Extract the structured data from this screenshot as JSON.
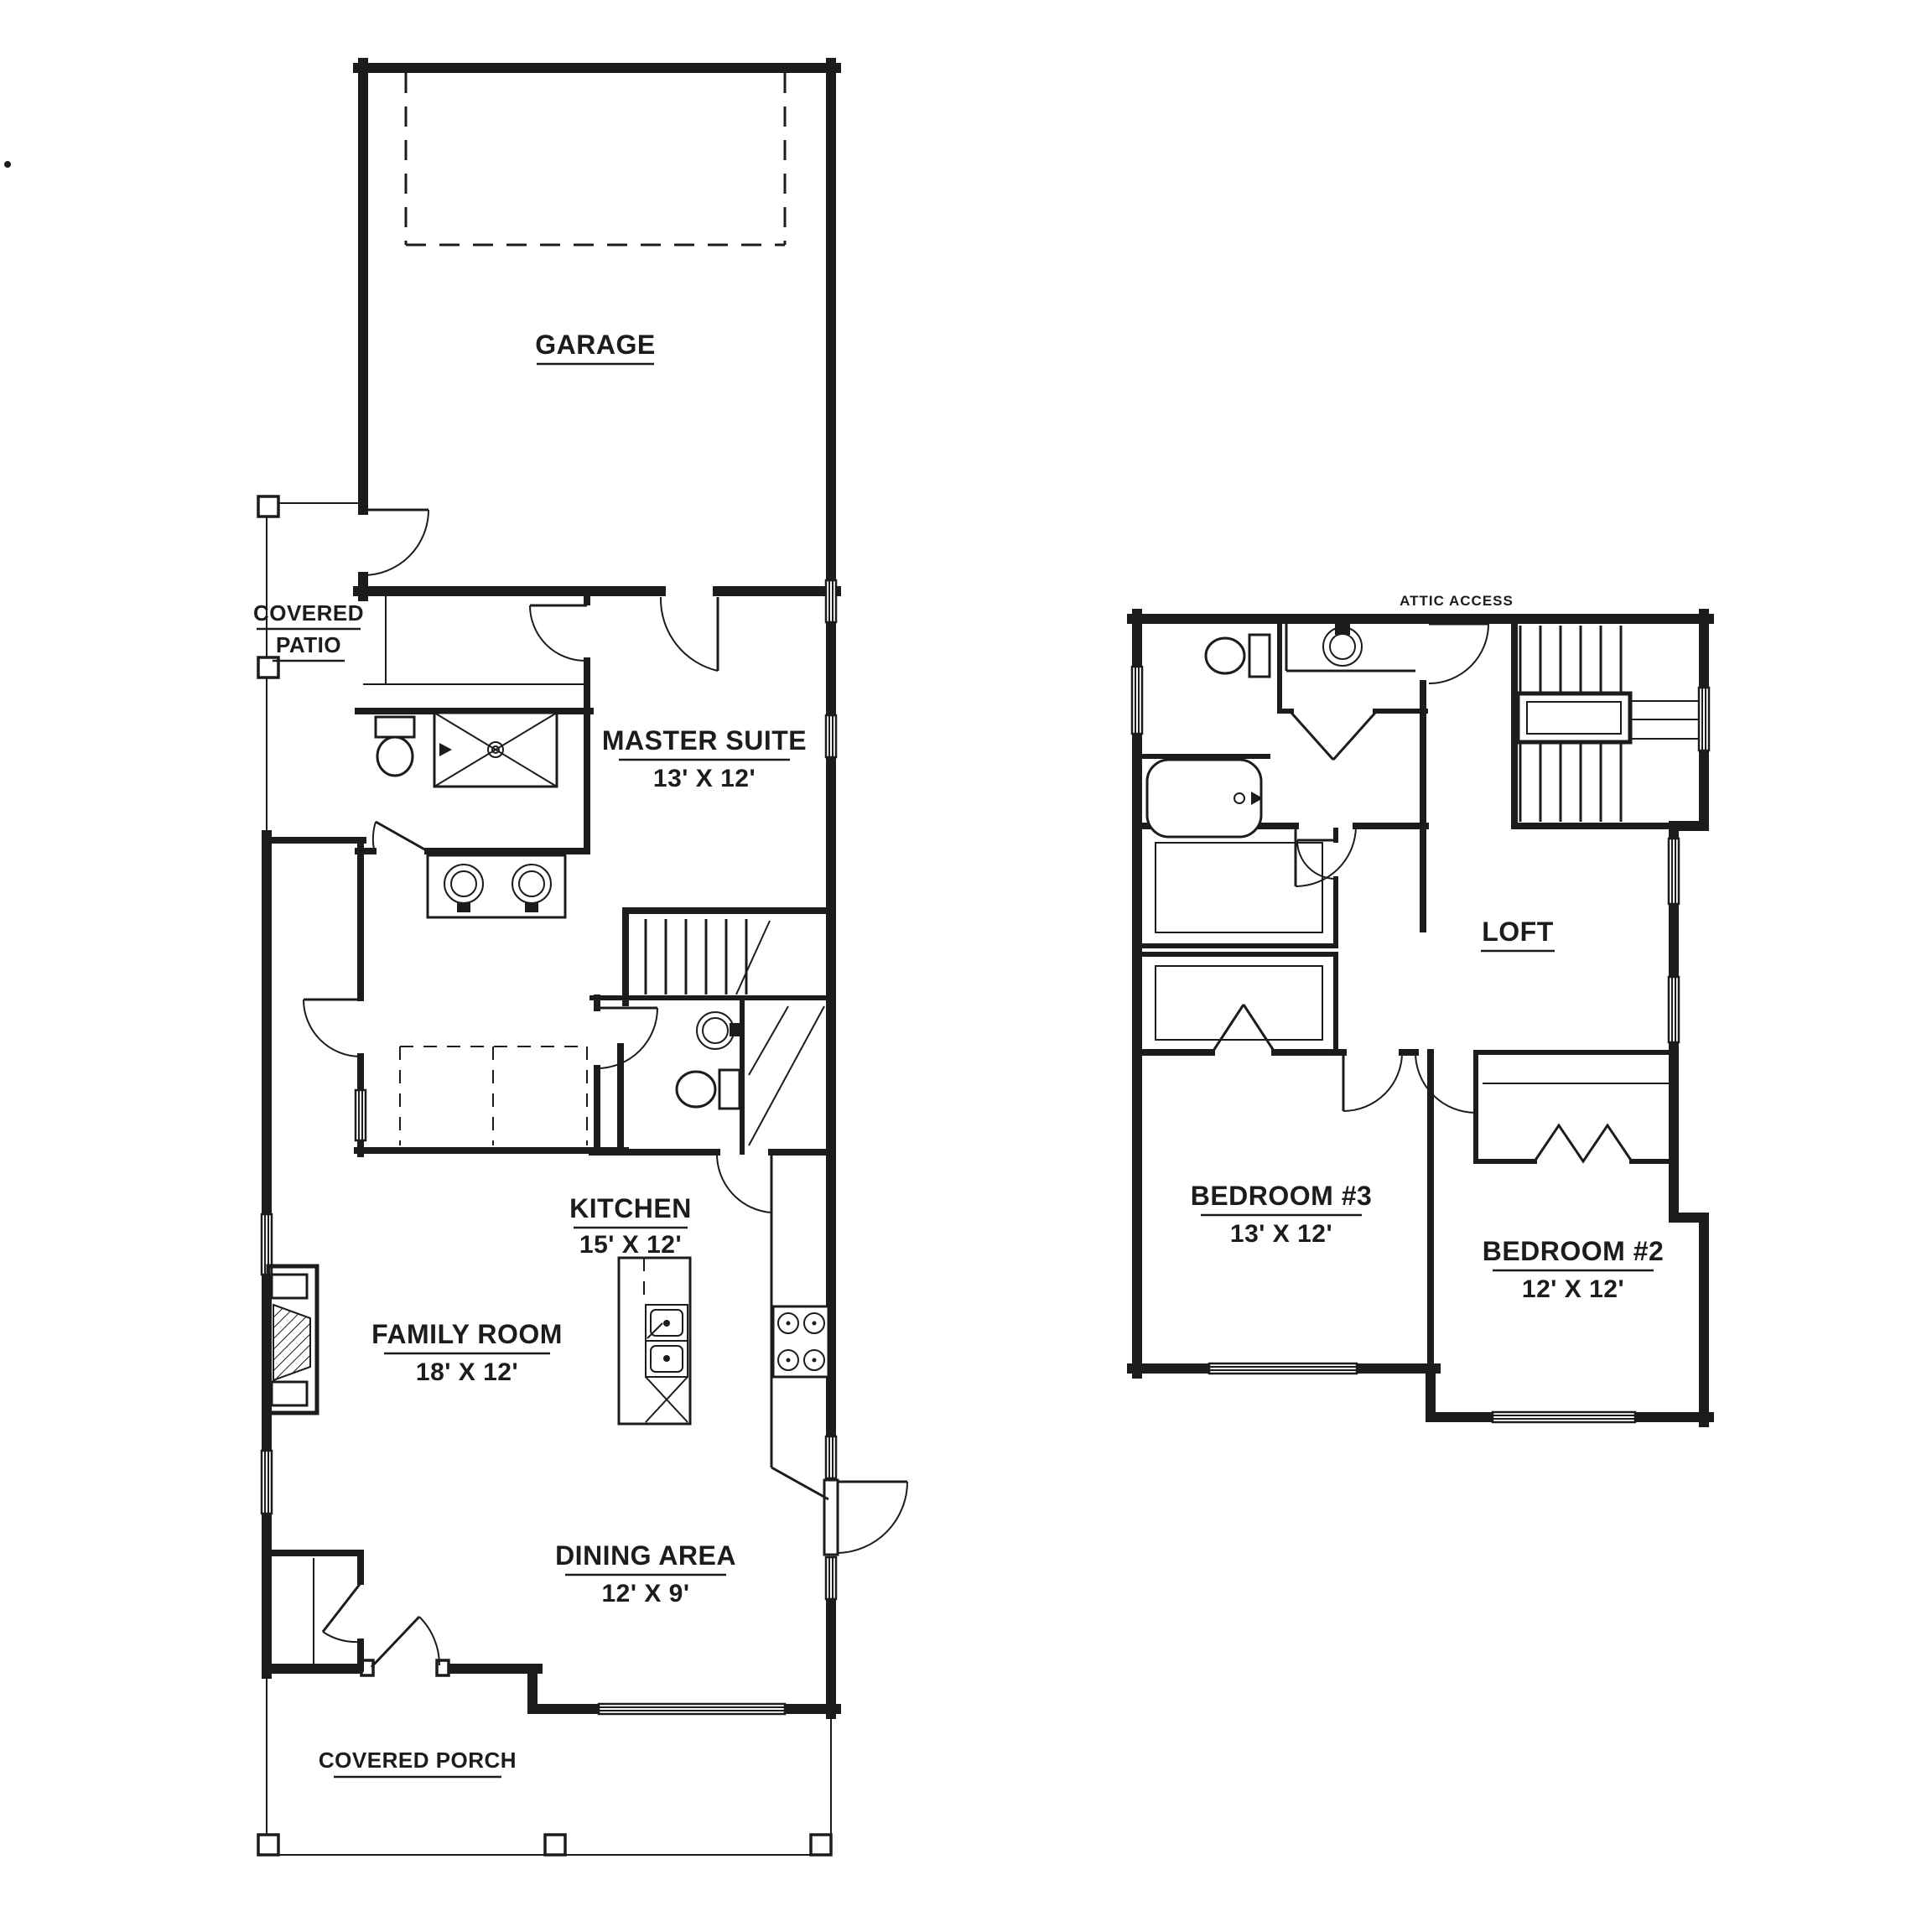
{
  "page": {
    "background": "#ffffff",
    "line_color": "#1c1c1c",
    "type": "architectural floor plan, two floors side by side"
  },
  "floor_plans": [
    {
      "id": "first-floor",
      "rooms": [
        {
          "key": "garage",
          "name": "GARAGE",
          "dims": ""
        },
        {
          "key": "covered_patio",
          "name": "COVERED PATIO",
          "line1": "COVERED",
          "line2": "PATIO"
        },
        {
          "key": "master_suite",
          "name": "MASTER SUITE",
          "dims": "13' X 12'"
        },
        {
          "key": "kitchen",
          "name": "KITCHEN",
          "dims": "15' X 12'"
        },
        {
          "key": "family_room",
          "name": "FAMILY ROOM",
          "dims": "18' X 12'"
        },
        {
          "key": "dining_area",
          "name": "DINING AREA",
          "dims": "12' X 9'"
        },
        {
          "key": "covered_porch",
          "name": "COVERED PORCH"
        }
      ]
    },
    {
      "id": "second-floor",
      "rooms": [
        {
          "key": "attic_access",
          "name": "ATTIC ACCESS"
        },
        {
          "key": "loft",
          "name": "LOFT"
        },
        {
          "key": "bedroom_3",
          "name": "BEDROOM #3",
          "dims": "13' X 12'"
        },
        {
          "key": "bedroom_2",
          "name": "BEDROOM #2",
          "dims": "12' X 12'"
        }
      ]
    }
  ],
  "stray_mark": "."
}
